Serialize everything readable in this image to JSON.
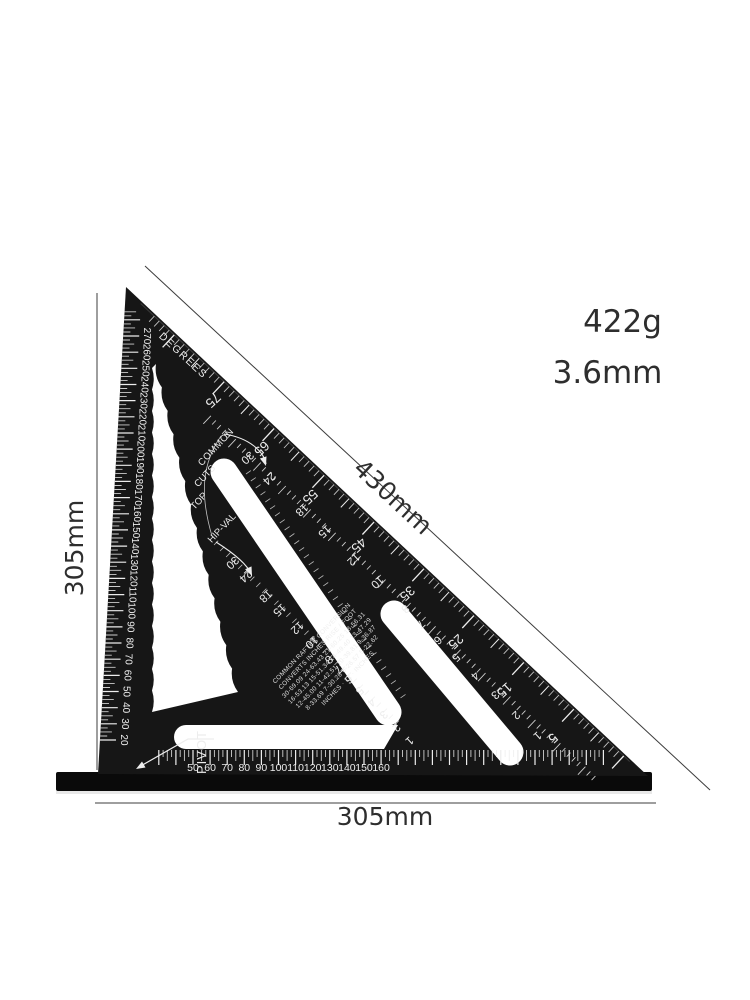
{
  "product_annotations": {
    "weight": "422g",
    "thickness": "3.6mm"
  },
  "dimensions": {
    "left": "305mm",
    "bottom": "305mm",
    "hypotenuse": "430mm"
  },
  "square": {
    "corner_label": "PIVOT",
    "degrees_label": "DEGREES",
    "scale_names": {
      "common": "COMMON",
      "cuts": "CUTS",
      "top": "TOP",
      "hip_val": "HIP-VAL"
    },
    "degree_scale": [
      "75",
      "65",
      "55",
      "45",
      "35",
      "25",
      "15",
      "5"
    ],
    "common_scale": [
      "30",
      "24",
      "18",
      "15",
      "12",
      "10",
      "8",
      "7",
      "6",
      "5",
      "4",
      "3",
      "2",
      "1"
    ],
    "hip_val_scale": [
      "30",
      "24",
      "18",
      "15",
      "12",
      "10",
      "8",
      "7",
      "6",
      "5",
      "4",
      "3",
      "2",
      "1"
    ],
    "left_ruler_labels": [
      "20",
      "30",
      "40",
      "50",
      "60",
      "70",
      "80",
      "90",
      "100",
      "110",
      "120",
      "130",
      "140",
      "150",
      "160",
      "170",
      "180",
      "190",
      "200",
      "210",
      "220",
      "230",
      "240",
      "250",
      "260",
      "270"
    ],
    "bottom_ruler_labels": [
      "50",
      "60",
      "70",
      "80",
      "90",
      "100",
      "110",
      "120",
      "130",
      "140",
      "150",
      "160"
    ],
    "conversion_table": {
      "lines": [
        "COMMON RAFTER CONVERSION",
        "CONVERTS INCHES RISE / FOOT",
        "30-69.09  24-63.43  21-60.25  18-56.31",
        "16-53.13  15-51.34  14-49.40  13-47.29",
        "12-45.00  11-42.51  10-39.81  9-36.87",
        "8-33.69  7-30.26  6-26.57  5-22.62",
        "INCHES  ·  12  ·  INCHES"
      ]
    }
  },
  "colors": {
    "body": "#161616",
    "flange": "#0a0a0a",
    "markings": "#ededed",
    "dimension_ink": "#2e2e2e",
    "background": "#ffffff"
  }
}
